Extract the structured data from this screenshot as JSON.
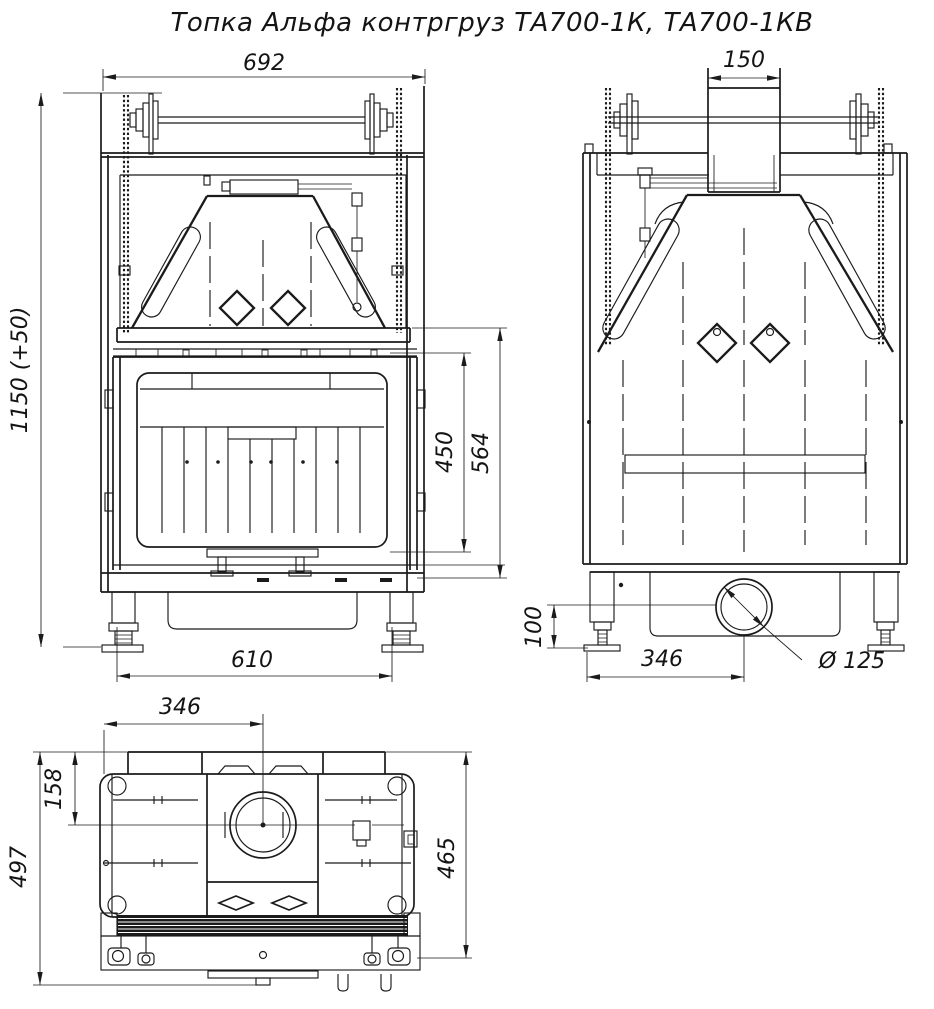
{
  "title": "Топка Альфа контргруз ТА700-1К, ТА700-1КВ",
  "drawing_type": "technical-drawing",
  "line_color": "#1b1b1b",
  "background": "#ffffff",
  "views": {
    "front": {
      "dimensions": {
        "overall_width": "692",
        "overall_height": "1150 (+50)",
        "glass_opening_height": "450",
        "firebox_height": "564",
        "feet_spacing": "610"
      }
    },
    "rear": {
      "dimensions": {
        "flue_duct_width": "150",
        "outlet_center_height": "100",
        "outlet_center_offset": "346",
        "outlet_diameter": "Ø 125"
      }
    },
    "top": {
      "dimensions": {
        "outlet_offset_from_side": "346",
        "outlet_offset_from_back": "158",
        "overall_depth": "497",
        "body_depth": "465"
      }
    }
  }
}
